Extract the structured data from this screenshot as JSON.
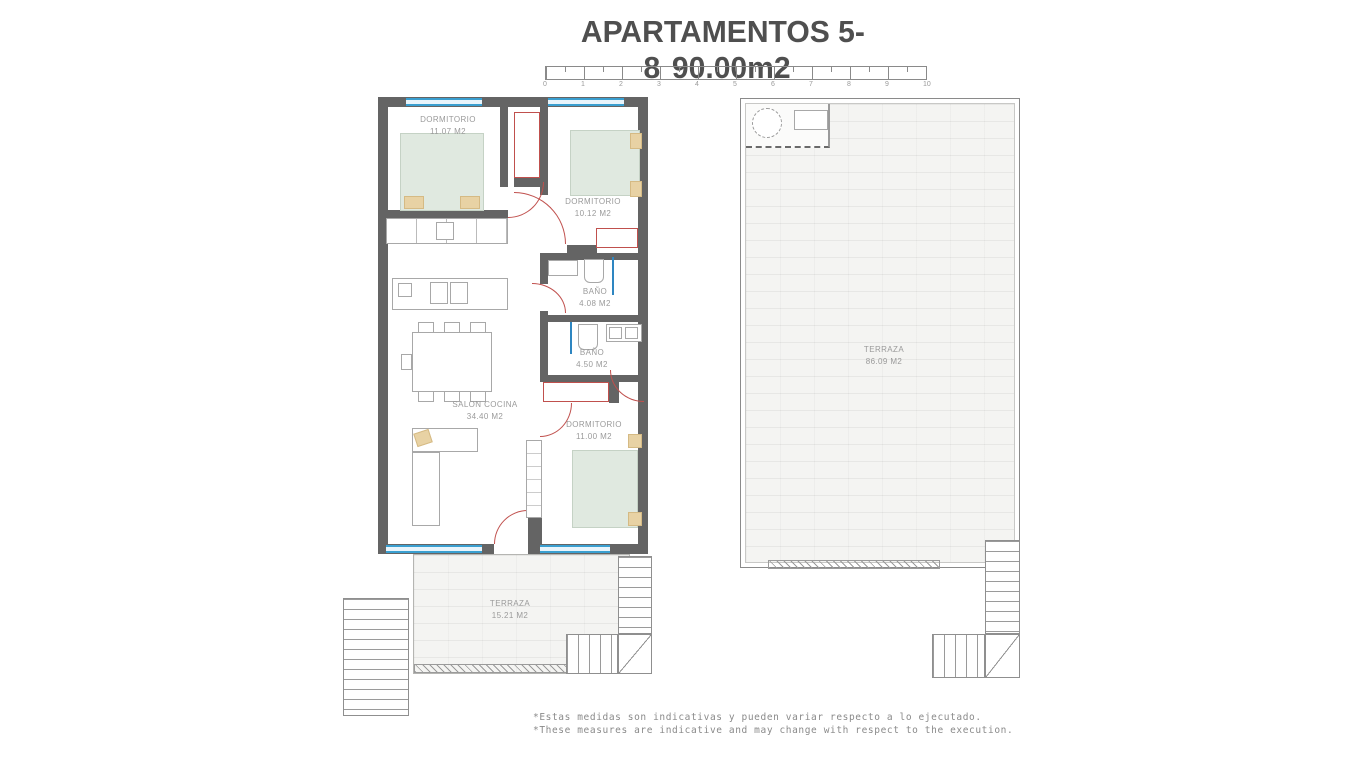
{
  "title": {
    "left": "APARTAMENTOS 5-8",
    "right": "90.00m2"
  },
  "scale_bar": {
    "ticks": [
      "0",
      "1",
      "2",
      "3",
      "4",
      "5",
      "6",
      "7",
      "8",
      "9",
      "10"
    ]
  },
  "apartment": {
    "dormitorio1": {
      "name": "DORMITORIO",
      "area": "11.07 M2"
    },
    "dormitorio2": {
      "name": "DORMITORIO",
      "area": "10.12 M2"
    },
    "bano1": {
      "name": "BAÑO",
      "area": "4.08 M2"
    },
    "bano2": {
      "name": "BAÑO",
      "area": "4.50 M2"
    },
    "salon": {
      "name": "SALON COCINA",
      "area": "34.40 M2"
    },
    "dormitorio3": {
      "name": "DORMITORIO",
      "area": "11.00 M2"
    },
    "terraza": {
      "name": "TERRAZA",
      "area": "15.21 M2"
    }
  },
  "roof_terrace": {
    "terraza": {
      "name": "TERRAZA",
      "area": "86.09 M2"
    }
  },
  "footnotes": {
    "line1": "*Estas medidas son indicativas y pueden variar respecto a lo ejecutado.",
    "line2": "*These measures are indicative and may change with respect to the execution."
  },
  "colors": {
    "wall": "#646464",
    "window": "#3a9fd0",
    "door": "#c0504d",
    "bed": "#e0e9e0",
    "pillow": "#e8d2a4",
    "terrace": "#f4f4f2",
    "label": "#9a9a9a",
    "title": "#4f4f4f"
  }
}
